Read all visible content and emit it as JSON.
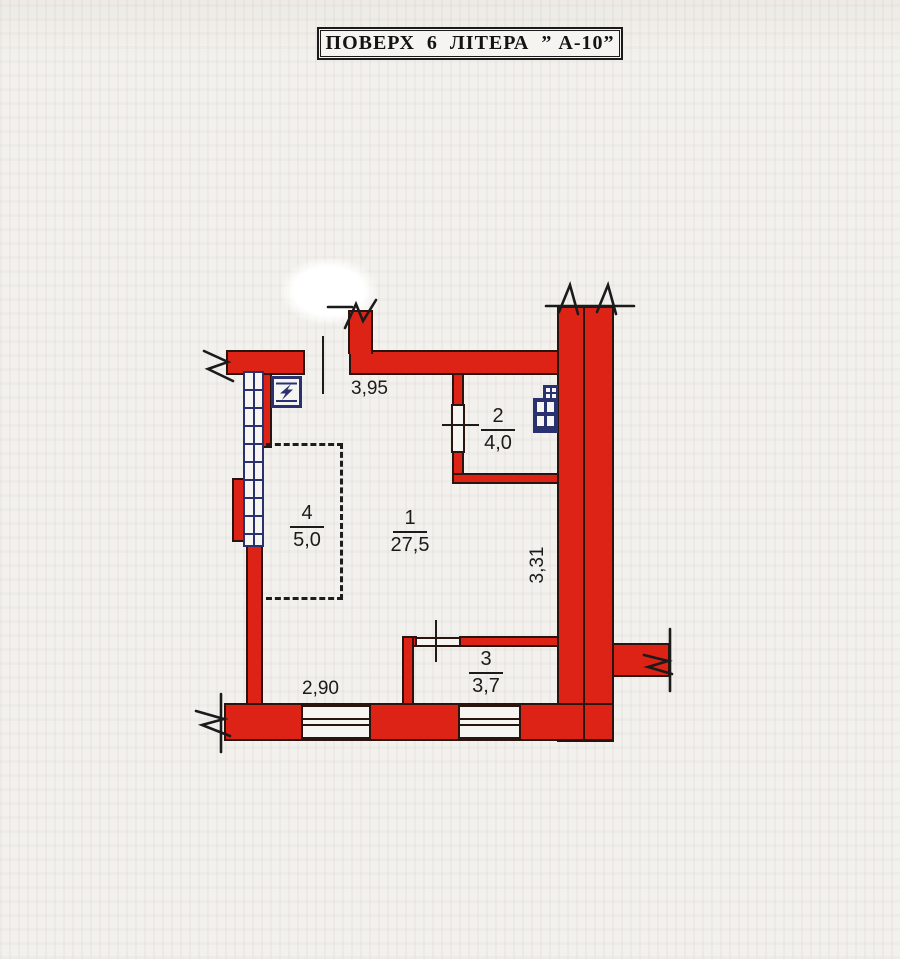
{
  "title": "ПОВЕРХ  6  ЛІТЕРА  ” А-10”",
  "plan": {
    "rooms": [
      {
        "number": "1",
        "area": "27,5"
      },
      {
        "number": "2",
        "area": "4,0"
      },
      {
        "number": "3",
        "area": "3,7"
      },
      {
        "number": "4",
        "area": "5,0"
      }
    ],
    "dimensions": {
      "top": "3,95",
      "right": "3,31",
      "bottom": "2,90"
    },
    "icons": {
      "electric_panel": "lightning-bolt-in-box",
      "ventilation": "vent-shaft-grid",
      "glazing": "window-ladder-grid",
      "break_marks": "wall-break-zigzag"
    },
    "colors": {
      "wall": "#dd2316",
      "glazing_blue": "#2a3170",
      "ink": "#1b1b1b",
      "paper": "#f3f1ed"
    }
  }
}
